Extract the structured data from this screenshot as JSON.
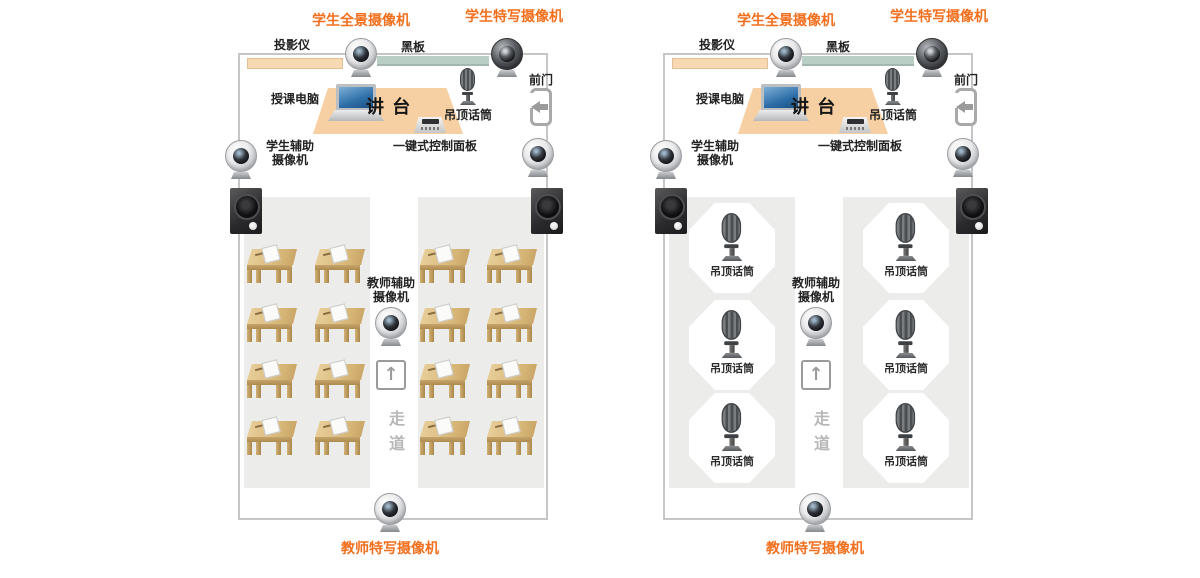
{
  "diagram": {
    "labels": {
      "student_panoramic_camera": "学生全景摄像机",
      "student_closeup_camera": "学生特写摄像机",
      "projector": "投影仪",
      "blackboard": "黑板",
      "teaching_computer": "授课电脑",
      "podium": "讲 台",
      "ceiling_mic": "吊顶话筒",
      "front_door": "前门",
      "student_aux_camera": "学生辅助\n摄像机",
      "one_key_control_panel": "一键式控制面板",
      "teacher_aux_camera": "教师辅助\n摄像机",
      "aisle": "走道",
      "teacher_closeup_camera": "教师特写摄像机"
    },
    "colors": {
      "accent_orange": "#f26f1e",
      "projector_bar": "#f7d9b3",
      "blackboard_bar": "#b9cec4",
      "podium_fill": "#f6cfa2",
      "seating_zone_fill": "#ececea",
      "room_border": "#c6c6c6",
      "aisle_text": "#b8b8b8",
      "desk_wood": "#d6b577"
    },
    "left_panel": {
      "seating": "desks"
    },
    "right_panel": {
      "seating": "ceiling_mic_zones"
    }
  }
}
